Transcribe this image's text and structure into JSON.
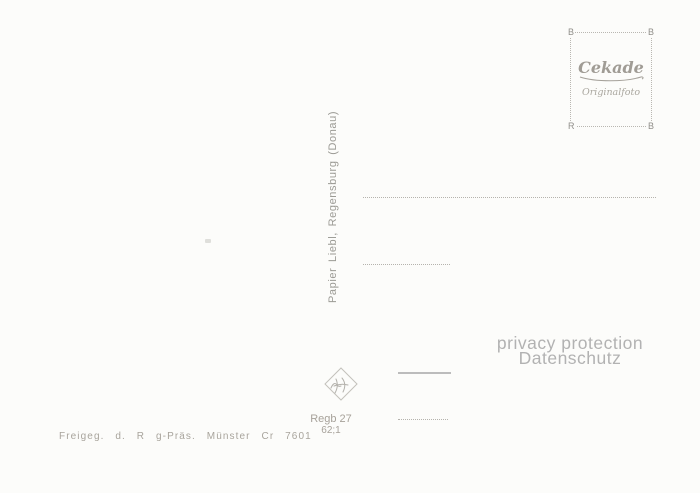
{
  "stamp_box": {
    "brand": "Cekade",
    "subtitle": "Originalfoto",
    "corners": {
      "top_left": "B",
      "top_right": "B",
      "bottom_left": "R",
      "bottom_right": "B"
    }
  },
  "spine_text": "Papier Liebl, Regensburg (Donau)",
  "privacy": {
    "line1": "privacy protection",
    "line2": "Datenschutz"
  },
  "footer": {
    "approval_text": "Freigeg. d. R g-Präs. Münster Cr 7601",
    "order_code_line1": "Regb 27",
    "order_code_line2": "62;1"
  },
  "icons": {
    "watermark": "diamond-script-logo"
  },
  "colors": {
    "background": "#fcfcfa",
    "ink": "#a19d96",
    "privacy_text": "#b2b2b2",
    "line_dotted": "#b5b3ad"
  }
}
